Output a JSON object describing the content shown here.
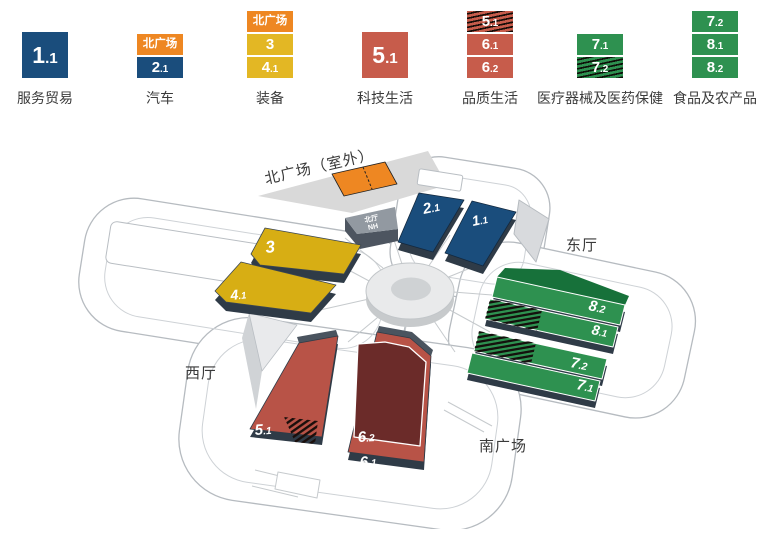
{
  "colors": {
    "blue": "#1a4d7c",
    "orange": "#ee8722",
    "yellow_legend": "#e3b724",
    "yellow_map": "#d7ae14",
    "red_legend": "#c75c4b",
    "red_map": "#b85347",
    "dark_red": "#6b2b29",
    "green": "#2e9150",
    "green_dark": "#17713a",
    "slab_base_dark": "#2f3b47",
    "plaza_gray": "#d9d9d9",
    "outline_gray": "#b6bbc0"
  },
  "legend": {
    "items": [
      {
        "label": "服务贸易",
        "boxes": [
          {
            "text": "1.1",
            "color": "blue",
            "size": "large",
            "hatched": false
          }
        ]
      },
      {
        "label": "汽车",
        "boxes": [
          {
            "text": "北广场",
            "color": "orange",
            "hatched": false
          },
          {
            "text": "2.1",
            "color": "blue",
            "hatched": false
          }
        ]
      },
      {
        "label": "装备",
        "boxes": [
          {
            "text": "北广场",
            "color": "orange",
            "hatched": false
          },
          {
            "text": "3",
            "color": "yellow",
            "hatched": false
          },
          {
            "text": "4.1",
            "color": "yellow",
            "hatched": false
          }
        ]
      },
      {
        "label": "科技生活",
        "boxes": [
          {
            "text": "5.1",
            "color": "red",
            "size": "large",
            "hatched": false
          }
        ]
      },
      {
        "label": "品质生活",
        "boxes": [
          {
            "text": "5.1",
            "color": "red",
            "hatched": true
          },
          {
            "text": "6.1",
            "color": "red",
            "hatched": false
          },
          {
            "text": "6.2",
            "color": "red",
            "hatched": false
          }
        ]
      },
      {
        "label": "医疗器械及医药保健",
        "boxes": [
          {
            "text": "7.1",
            "color": "green",
            "hatched": false
          },
          {
            "text": "7.2",
            "color": "green",
            "hatched": true
          }
        ]
      },
      {
        "label": "食品及农产品",
        "boxes": [
          {
            "text": "7.2",
            "color": "green",
            "hatched": false
          },
          {
            "text": "8.1",
            "color": "green",
            "hatched": false
          },
          {
            "text": "8.2",
            "color": "green",
            "hatched": false
          }
        ]
      }
    ]
  },
  "map": {
    "areas": {
      "north_plaza": "北广场（室外）",
      "north_hall": "北厅",
      "north_hall_code": "NH",
      "east_hall": "东厅",
      "west_hall": "西厅",
      "south_plaza": "南广场"
    },
    "halls": {
      "h11": "1.1",
      "h21": "2.1",
      "h3": "3",
      "h41": "4.1",
      "h51": "5.1",
      "h61": "6.1",
      "h62": "6.2",
      "h71": "7.1",
      "h72": "7.2",
      "h81": "8.1",
      "h82": "8.2"
    }
  }
}
